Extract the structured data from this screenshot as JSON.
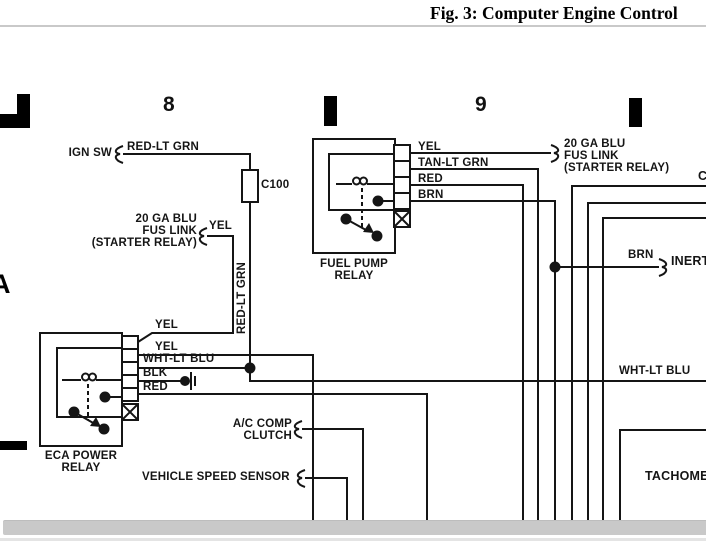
{
  "figure": {
    "title": "Fig. 3: Computer Engine Control"
  },
  "grid_markers": {
    "column_8": "8",
    "column_9": "9",
    "row_a": "A"
  },
  "ign_circuit": {
    "source_label": "IGN SW",
    "wire_label": "RED-LT GRN",
    "connector_label": "C100",
    "vertical_wire_label": "RED-LT GRN"
  },
  "fus_link_left": {
    "line1": "20 GA BLU",
    "line2": "FUS LINK",
    "line3": "(STARTER RELAY)",
    "wire_label": "YEL"
  },
  "fus_link_right": {
    "line1": "20 GA BLU",
    "line2": "FUS LINK",
    "line3": "(STARTER RELAY)"
  },
  "fuel_pump_relay": {
    "name_line1": "FUEL PUMP",
    "name_line2": "RELAY",
    "wires": [
      "YEL",
      "TAN-LT GRN",
      "RED",
      "BRN"
    ]
  },
  "eca_power_relay": {
    "name_line1": "ECA POWER",
    "name_line2": "RELAY",
    "wires": [
      "YEL",
      "YEL",
      "WHT-LT BLU",
      "BLK",
      "RED"
    ]
  },
  "branches": {
    "inertia_wire_label": "BRN",
    "inertia_target": "INERT",
    "wht_lt_blu_label": "WHT-LT BLU",
    "ac_comp_line1": "A/C COMP",
    "ac_comp_line2": "CLUTCH",
    "vehicle_speed_sensor": "VEHICLE SPEED SENSOR",
    "tachometer": "TACHOMET",
    "right_edge_connector": "C"
  },
  "colors": {
    "wire": "#151515",
    "scrollbar": "#c9c9c9"
  }
}
